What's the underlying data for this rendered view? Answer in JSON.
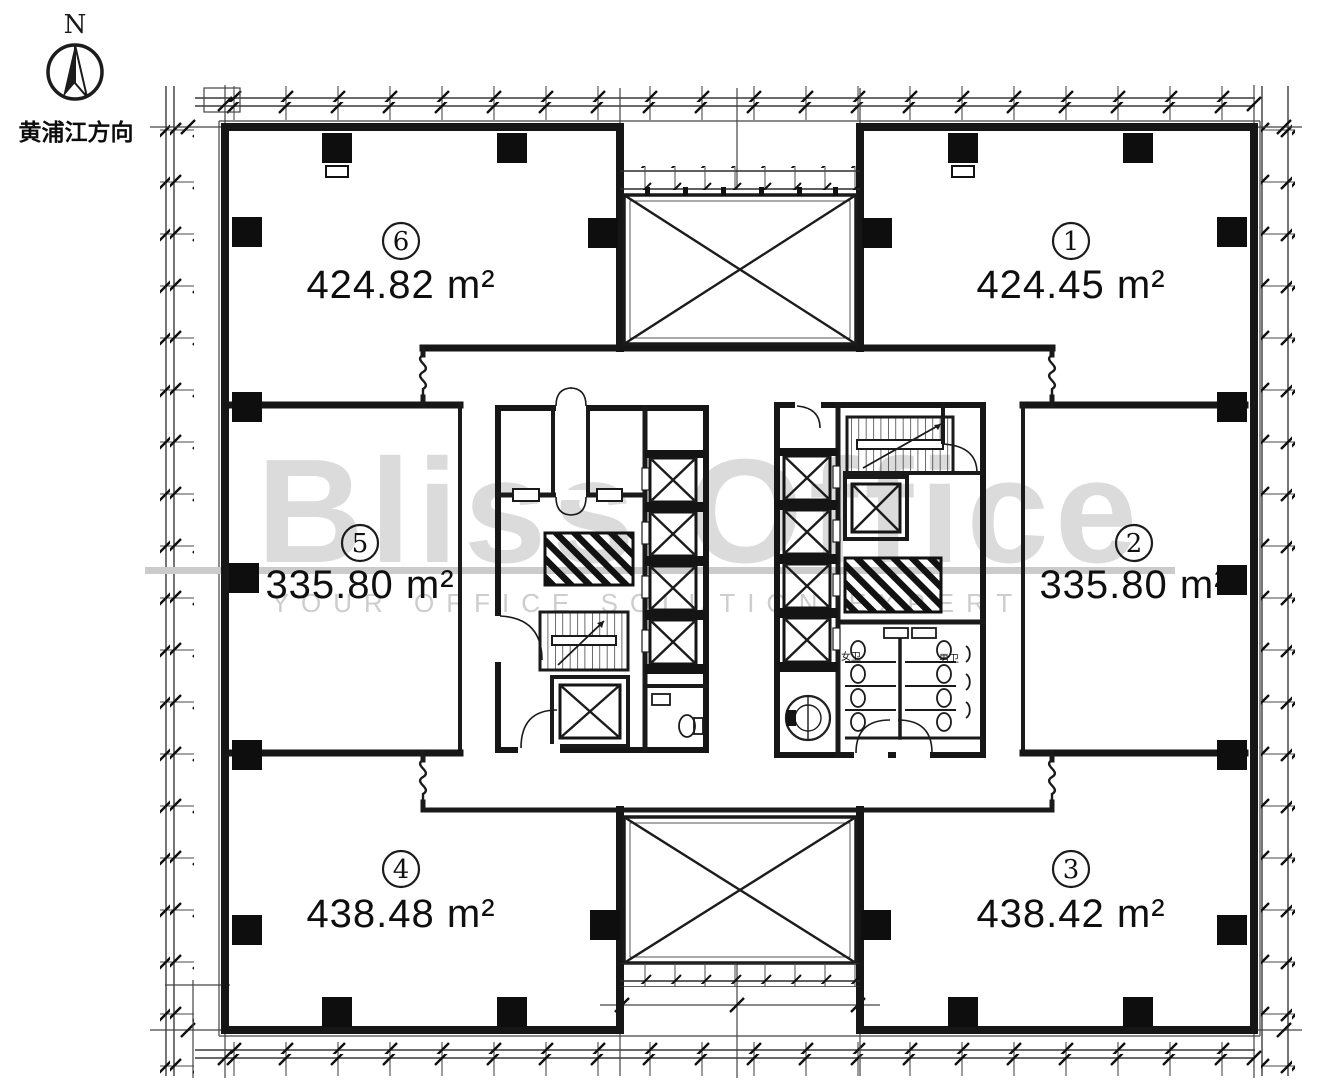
{
  "page": {
    "background": "#ffffff"
  },
  "compass": {
    "north_label": "N",
    "direction_label": "黄浦江方向"
  },
  "watermark": {
    "brand": "Bliss Office",
    "tagline": "YOUR OFFICE SOLUTION EXPERT",
    "color": "#c6c6c6"
  },
  "units": [
    {
      "number": "1",
      "area": "424.45 m²",
      "position": "top-right"
    },
    {
      "number": "2",
      "area": "335.80 m²",
      "position": "middle-right"
    },
    {
      "number": "3",
      "area": "438.42 m²",
      "position": "bottom-right"
    },
    {
      "number": "4",
      "area": "438.48 m²",
      "position": "bottom-left"
    },
    {
      "number": "5",
      "area": "335.80 m²",
      "position": "middle-left"
    },
    {
      "number": "6",
      "area": "424.82 m²",
      "position": "top-left"
    }
  ],
  "core": {
    "womens_restroom_label": "女卫",
    "mens_restroom_label": "男卫"
  },
  "colors": {
    "ink": "#1a1a1a",
    "watermark_gray": "#c6c6c6",
    "column_black": "#0e0e0e"
  }
}
